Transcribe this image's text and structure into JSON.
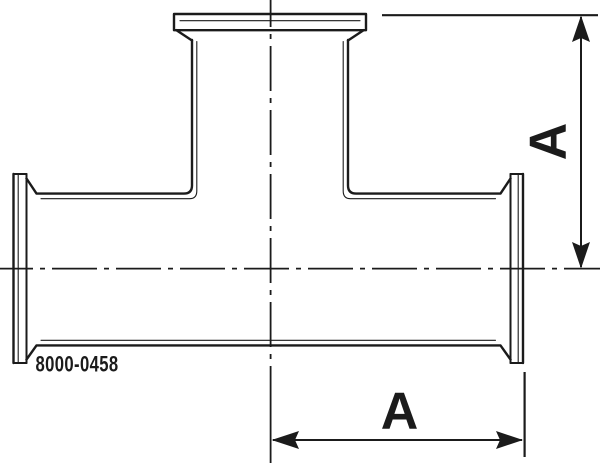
{
  "part_number": "8000-0458",
  "dimensions": {
    "vertical_label": "A",
    "horizontal_label": "A"
  },
  "colors": {
    "line": "#1b1b1b",
    "background": "#ffffff"
  }
}
